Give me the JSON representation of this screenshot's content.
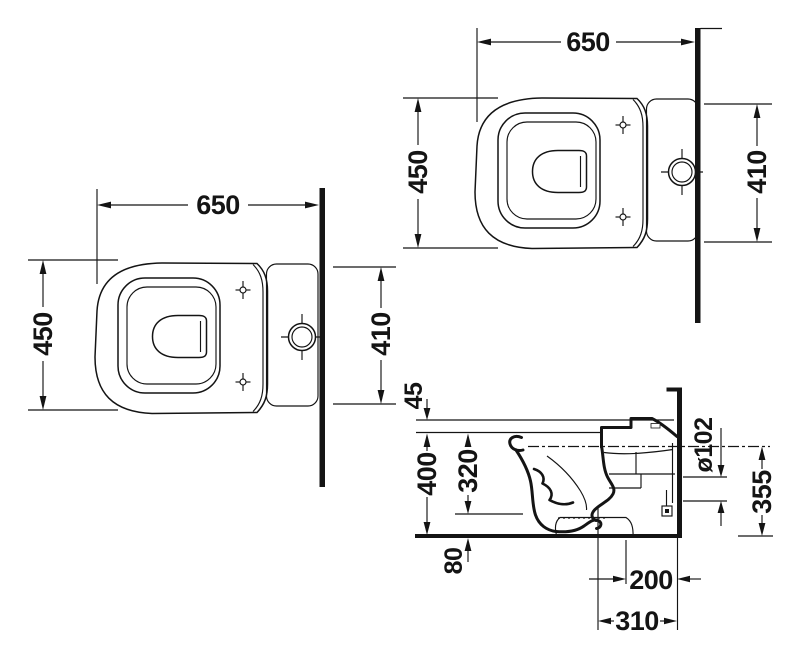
{
  "colors": {
    "background": "#ffffff",
    "ink": "#141414"
  },
  "views": {
    "plan_left": {
      "length": "650",
      "width": "450",
      "tank_width": "410"
    },
    "plan_right": {
      "length": "650",
      "width": "450",
      "tank_width": "410"
    },
    "side": {
      "seat_thickness": "45",
      "rim_height": "400",
      "inner_height": "320",
      "outlet_bottom_height": "80",
      "outlet_diameter": "ø102",
      "outlet_top_height": "355",
      "outlet_offset_wall": "200",
      "trap_center_wall": "310"
    }
  }
}
